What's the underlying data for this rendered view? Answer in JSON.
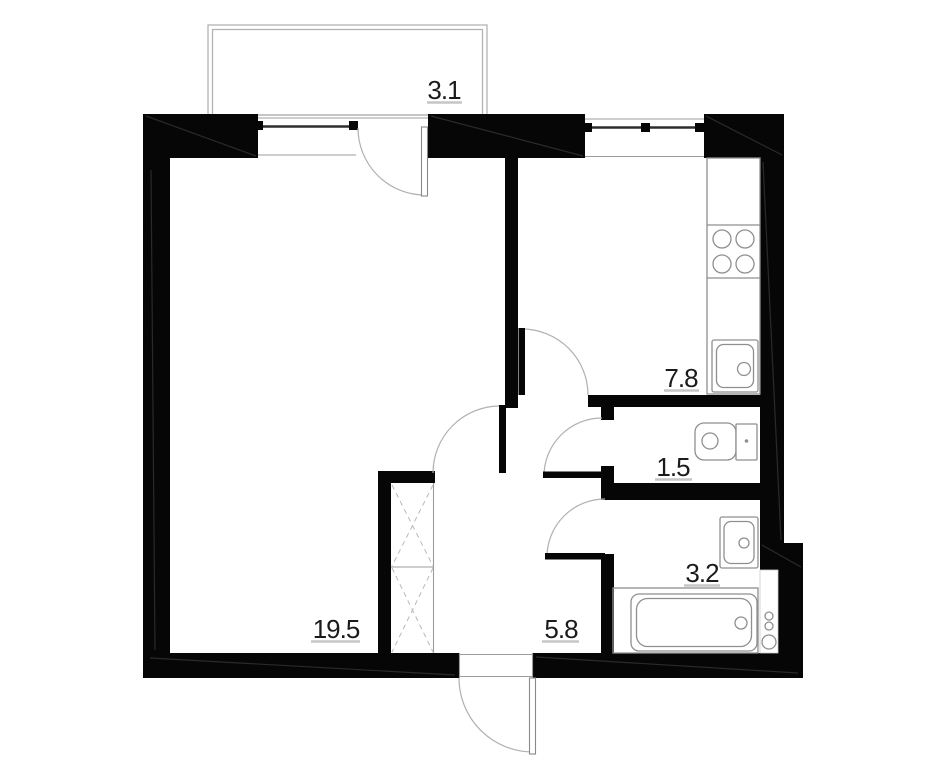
{
  "document": {
    "type": "apartment-floor-plan"
  },
  "rooms": {
    "balcony": {
      "name": "balcony",
      "area_label": "3.1"
    },
    "living_room": {
      "name": "living-room",
      "area_label": "19.5"
    },
    "kitchen": {
      "name": "kitchen",
      "area_label": "7.8"
    },
    "wc": {
      "name": "wc",
      "area_label": "1.5"
    },
    "bathroom": {
      "name": "bathroom",
      "area_label": "3.2"
    },
    "hallway": {
      "name": "hallway",
      "area_label": "5.8"
    }
  },
  "fixtures": [
    "stove-4-burners",
    "kitchen-sink",
    "toilet",
    "wash-basin",
    "bathtub",
    "plumbing-risers",
    "wardrobe-crossed",
    "entrance-door",
    "balcony-door",
    "interior-doors",
    "windows"
  ],
  "colors": {
    "wall": "#060606",
    "fixture_line": "#8f8f8f",
    "light_line": "#b3b3b3",
    "label_text": "#1b1b1b",
    "label_underline": "#c6c6c6",
    "background": "#ffffff"
  }
}
